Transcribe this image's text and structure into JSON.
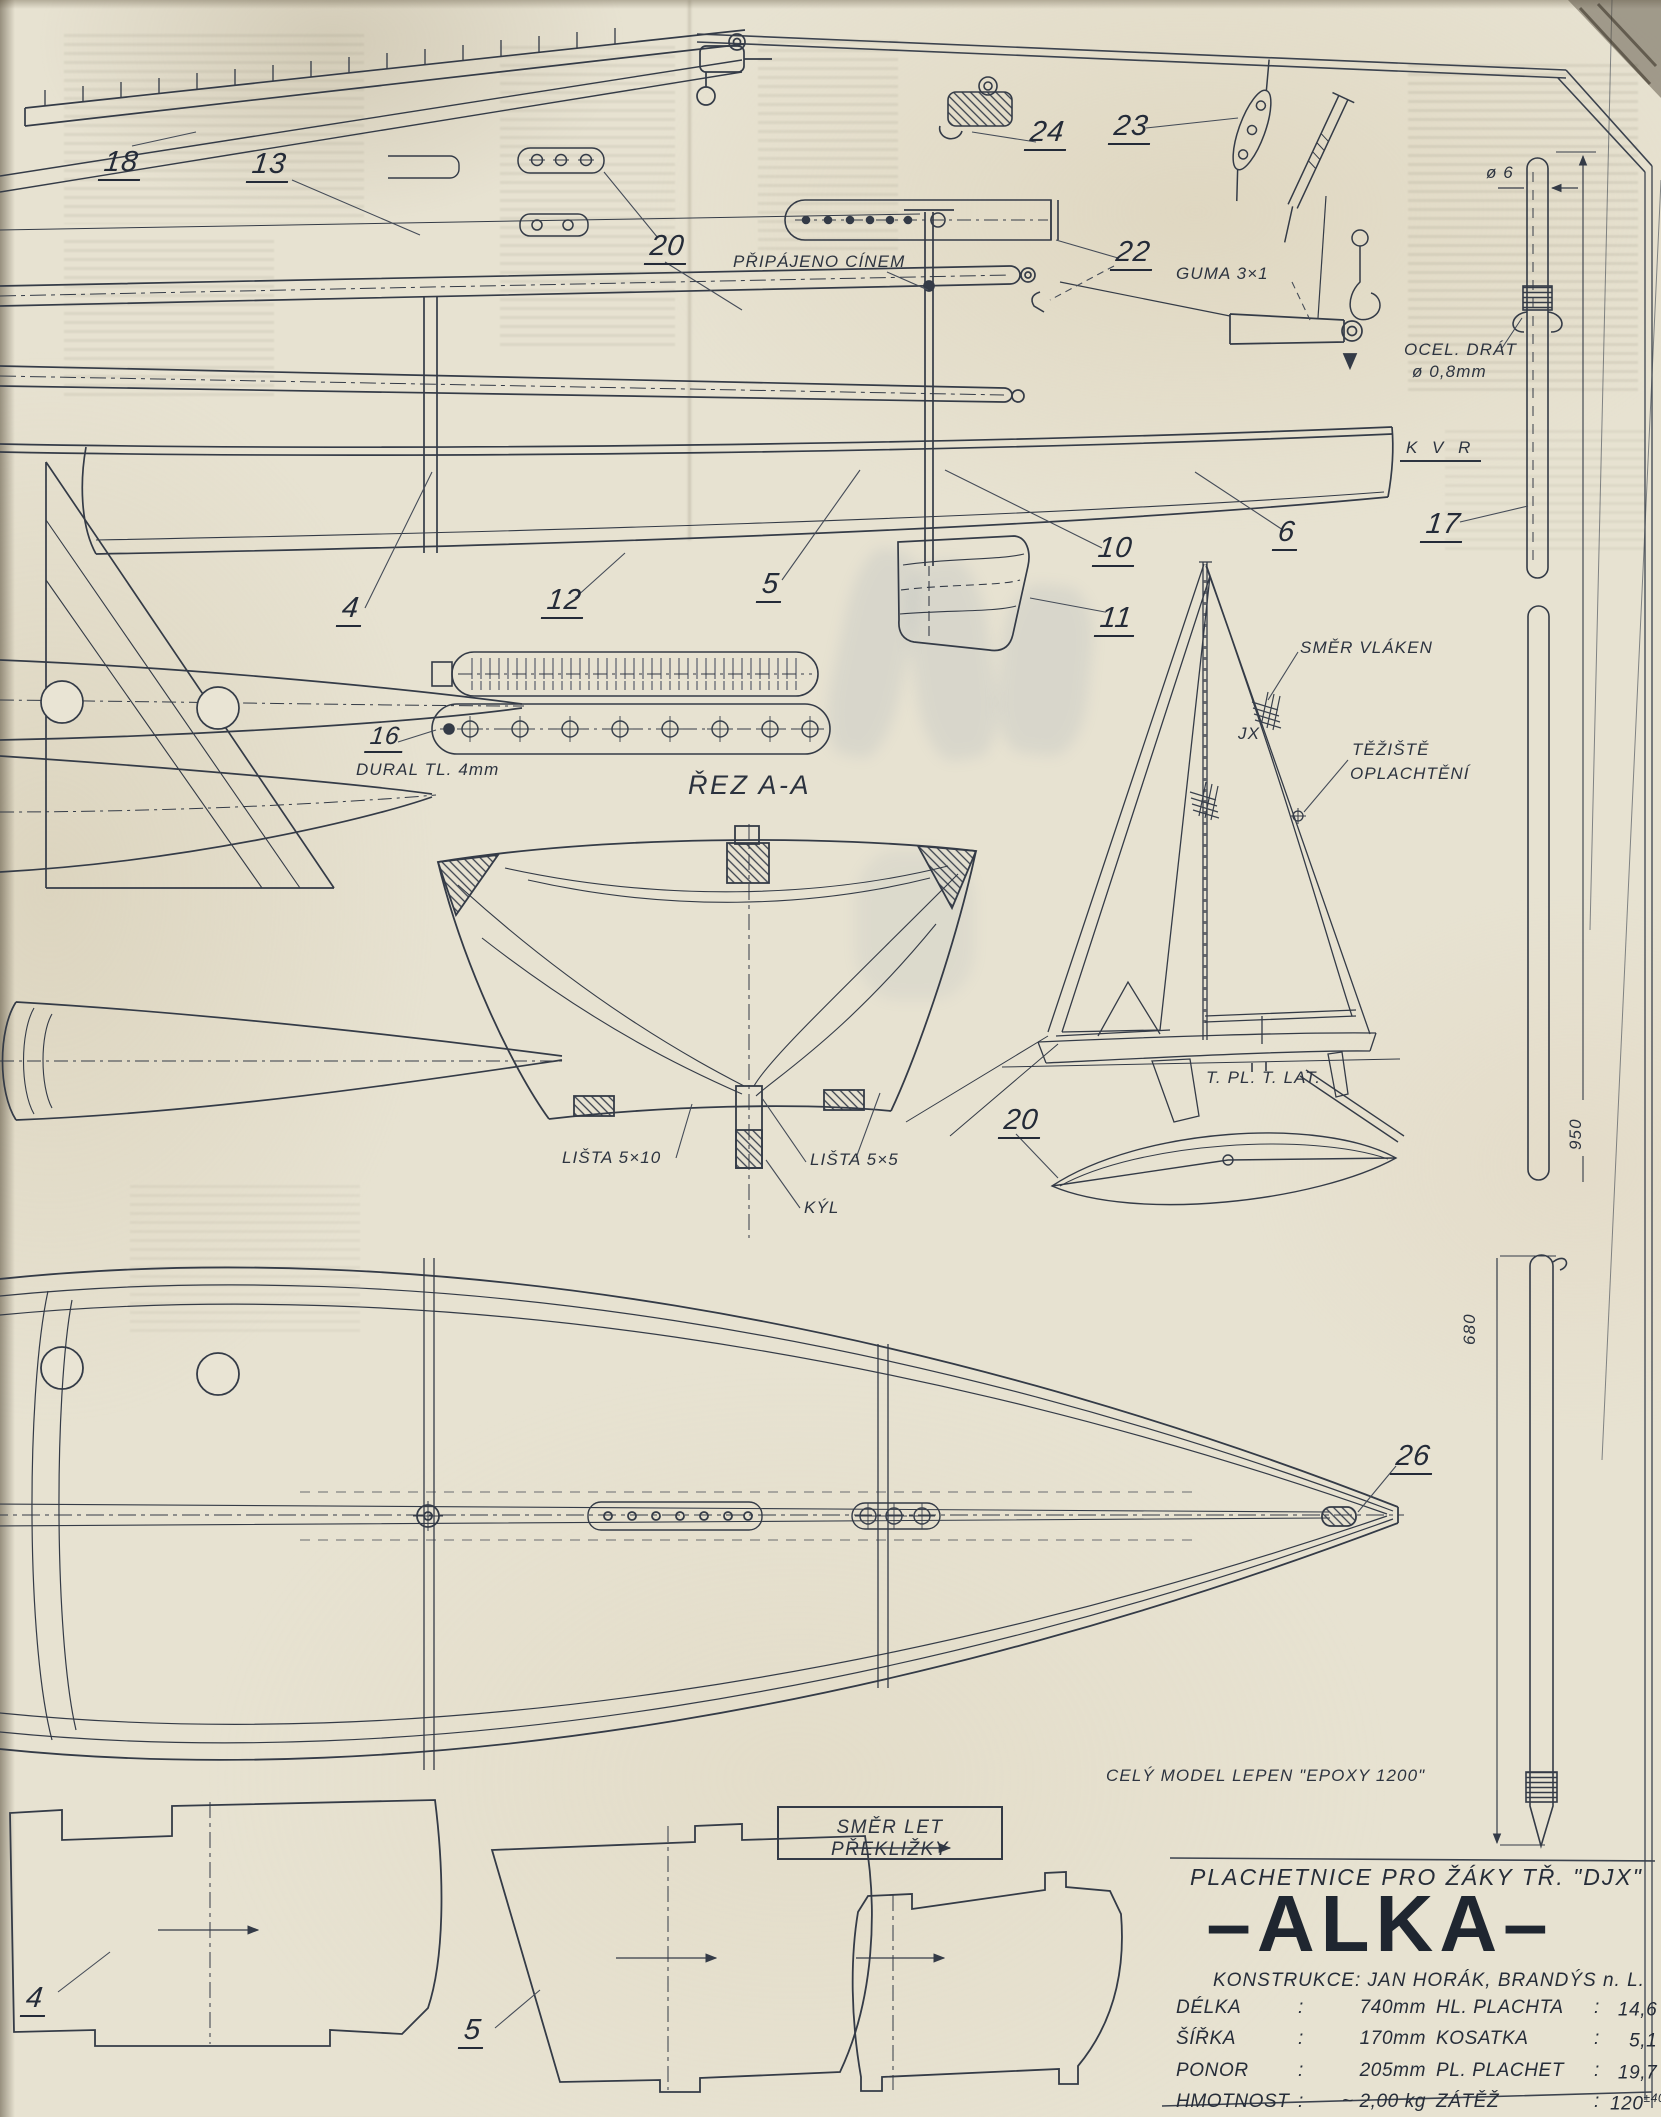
{
  "colors": {
    "paper": "#e7e2d1",
    "ink": "#343b47"
  },
  "labels": {
    "part18": "18",
    "part13": "13",
    "part20_top": "20",
    "part24": "24",
    "part23": "23",
    "part22": "22",
    "part10": "10",
    "part11": "11",
    "part6": "6",
    "part17": "17",
    "part4": "4",
    "part12": "12",
    "part5": "5",
    "part16": "16",
    "part20_mid": "20",
    "part26": "26",
    "part4_frame": "4",
    "part5_frame": "5",
    "pripajeno": "PŘIPÁJENO CÍNEM",
    "guma": "GUMA 3×1",
    "ocel1": "OCEL. DRÁT",
    "ocel2": "ø 0,8mm",
    "dia6": "ø 6",
    "kvr": "K V R",
    "dural": "DURAL TL. 4mm",
    "rez": "ŘEZ A-A",
    "smer_vlaken": "SMĚR VLÁKEN",
    "jx": "JX",
    "teziste1": "TĚŽIŠTĚ",
    "teziste2": "OPLACHTĚNÍ",
    "tpl": "T. PL.",
    "tlat": "T. LAT.",
    "lista510": "LIŠTA 5×10",
    "lista55": "LIŠTA 5×5",
    "kyl": "KÝL",
    "dim950": "950",
    "dim680": "680",
    "cely_model": "CELÝ MODEL LEPEN \"EPOXY 1200\"",
    "smer_let": "SMĚR LET PŘEKLIŽKY"
  },
  "titleblock": {
    "subtitle": "PLACHETNICE PRO ŽÁKY TŘ. \"DJX\"",
    "title": "–ALKA–",
    "construction": "KONSTRUKCE: JAN HORÁK, BRANDÝS n. L.",
    "specs": [
      {
        "k": "DÉLKA",
        "c": ":",
        "v": "740mm",
        "k2": "HL. PLACHTA",
        "c2": ":",
        "v2": "14,6 dm²"
      },
      {
        "k": "ŠÍŘKA",
        "c": ":",
        "v": "170mm",
        "k2": "KOSATKA",
        "c2": ":",
        "v2": "5,1 dm²"
      },
      {
        "k": "PONOR",
        "c": ":",
        "v": "205mm",
        "k2": "PL. PLACHET",
        "c2": ":",
        "v2": "19,7 dm²"
      },
      {
        "k": "HMOTNOST",
        "c": ":",
        "v": "~ 2,00 kg",
        "k2": "ZÁTĚŽ",
        "c2": ":",
        "v2": "120",
        "v2sup": "±40",
        "v2unit": "dkg"
      }
    ]
  }
}
